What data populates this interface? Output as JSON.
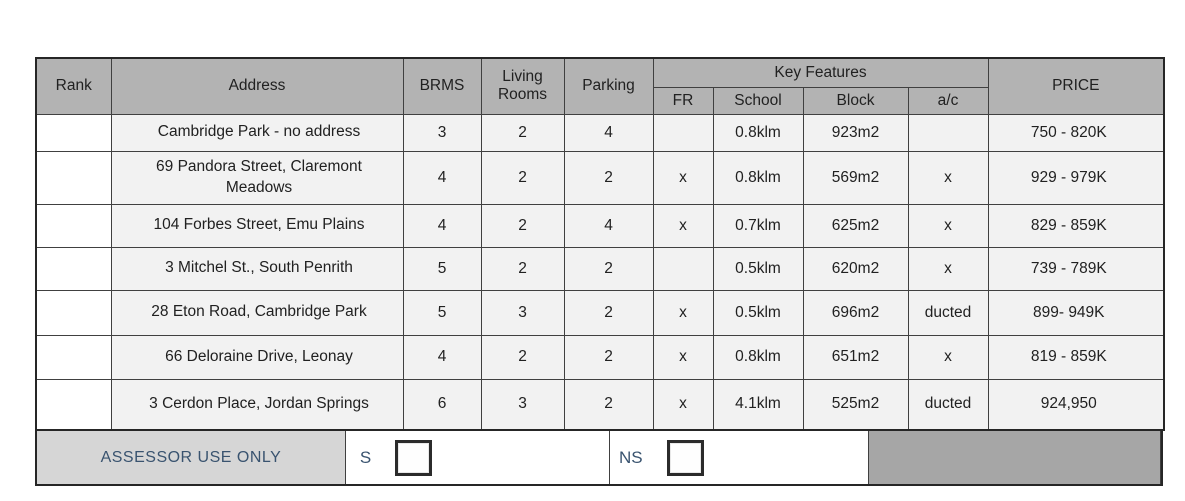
{
  "table": {
    "headers": {
      "rank": "Rank",
      "address": "Address",
      "brms": "BRMS",
      "living_rooms": "Living Rooms",
      "parking": "Parking",
      "key_features": "Key Features",
      "fr": "FR",
      "school": "School",
      "block": "Block",
      "ac": "a/c",
      "price": "PRICE"
    },
    "rows": [
      {
        "rank": "",
        "address": "Cambridge Park - no address",
        "brms": "3",
        "living": "2",
        "parking": "4",
        "fr": "",
        "school": "0.8klm",
        "block": "923m2",
        "ac": "",
        "price": "750 - 820K"
      },
      {
        "rank": "",
        "address": "69 Pandora Street, Claremont\nMeadows",
        "brms": "4",
        "living": "2",
        "parking": "2",
        "fr": "x",
        "school": "0.8klm",
        "block": "569m2",
        "ac": "x",
        "price": "929 - 979K"
      },
      {
        "rank": "",
        "address": "104 Forbes Street, Emu Plains",
        "brms": "4",
        "living": "2",
        "parking": "4",
        "fr": "x",
        "school": "0.7klm",
        "block": "625m2",
        "ac": "x",
        "price": "829 - 859K"
      },
      {
        "rank": "",
        "address": "3 Mitchel St., South Penrith",
        "brms": "5",
        "living": "2",
        "parking": "2",
        "fr": "",
        "school": "0.5klm",
        "block": "620m2",
        "ac": "x",
        "price": "739 - 789K"
      },
      {
        "rank": "",
        "address": "28 Eton Road, Cambridge Park",
        "brms": "5",
        "living": "3",
        "parking": "2",
        "fr": "x",
        "school": "0.5klm",
        "block": "696m2",
        "ac": "ducted",
        "price": "899- 949K"
      },
      {
        "rank": "",
        "address": "66 Deloraine Drive, Leonay",
        "brms": "4",
        "living": "2",
        "parking": "2",
        "fr": "x",
        "school": "0.8klm",
        "block": "651m2",
        "ac": "x",
        "price": "819 - 859K"
      },
      {
        "rank": "",
        "address": "3 Cerdon Place, Jordan Springs",
        "brms": "6",
        "living": "3",
        "parking": "2",
        "fr": "x",
        "school": "4.1klm",
        "block": "525m2",
        "ac": "ducted",
        "price": "924,950"
      }
    ]
  },
  "footer": {
    "assessor_label": "ASSESSOR USE ONLY",
    "s_label": "S",
    "ns_label": "NS"
  },
  "colors": {
    "header_gray": "#b3b3b3",
    "row_background": "#f2f2f2",
    "assessor_cell_gray": "#d6d6d6",
    "footer_blank_gray": "#a6a6a6",
    "accent_navy_text": "#39536f",
    "grid_border": "#404040"
  }
}
